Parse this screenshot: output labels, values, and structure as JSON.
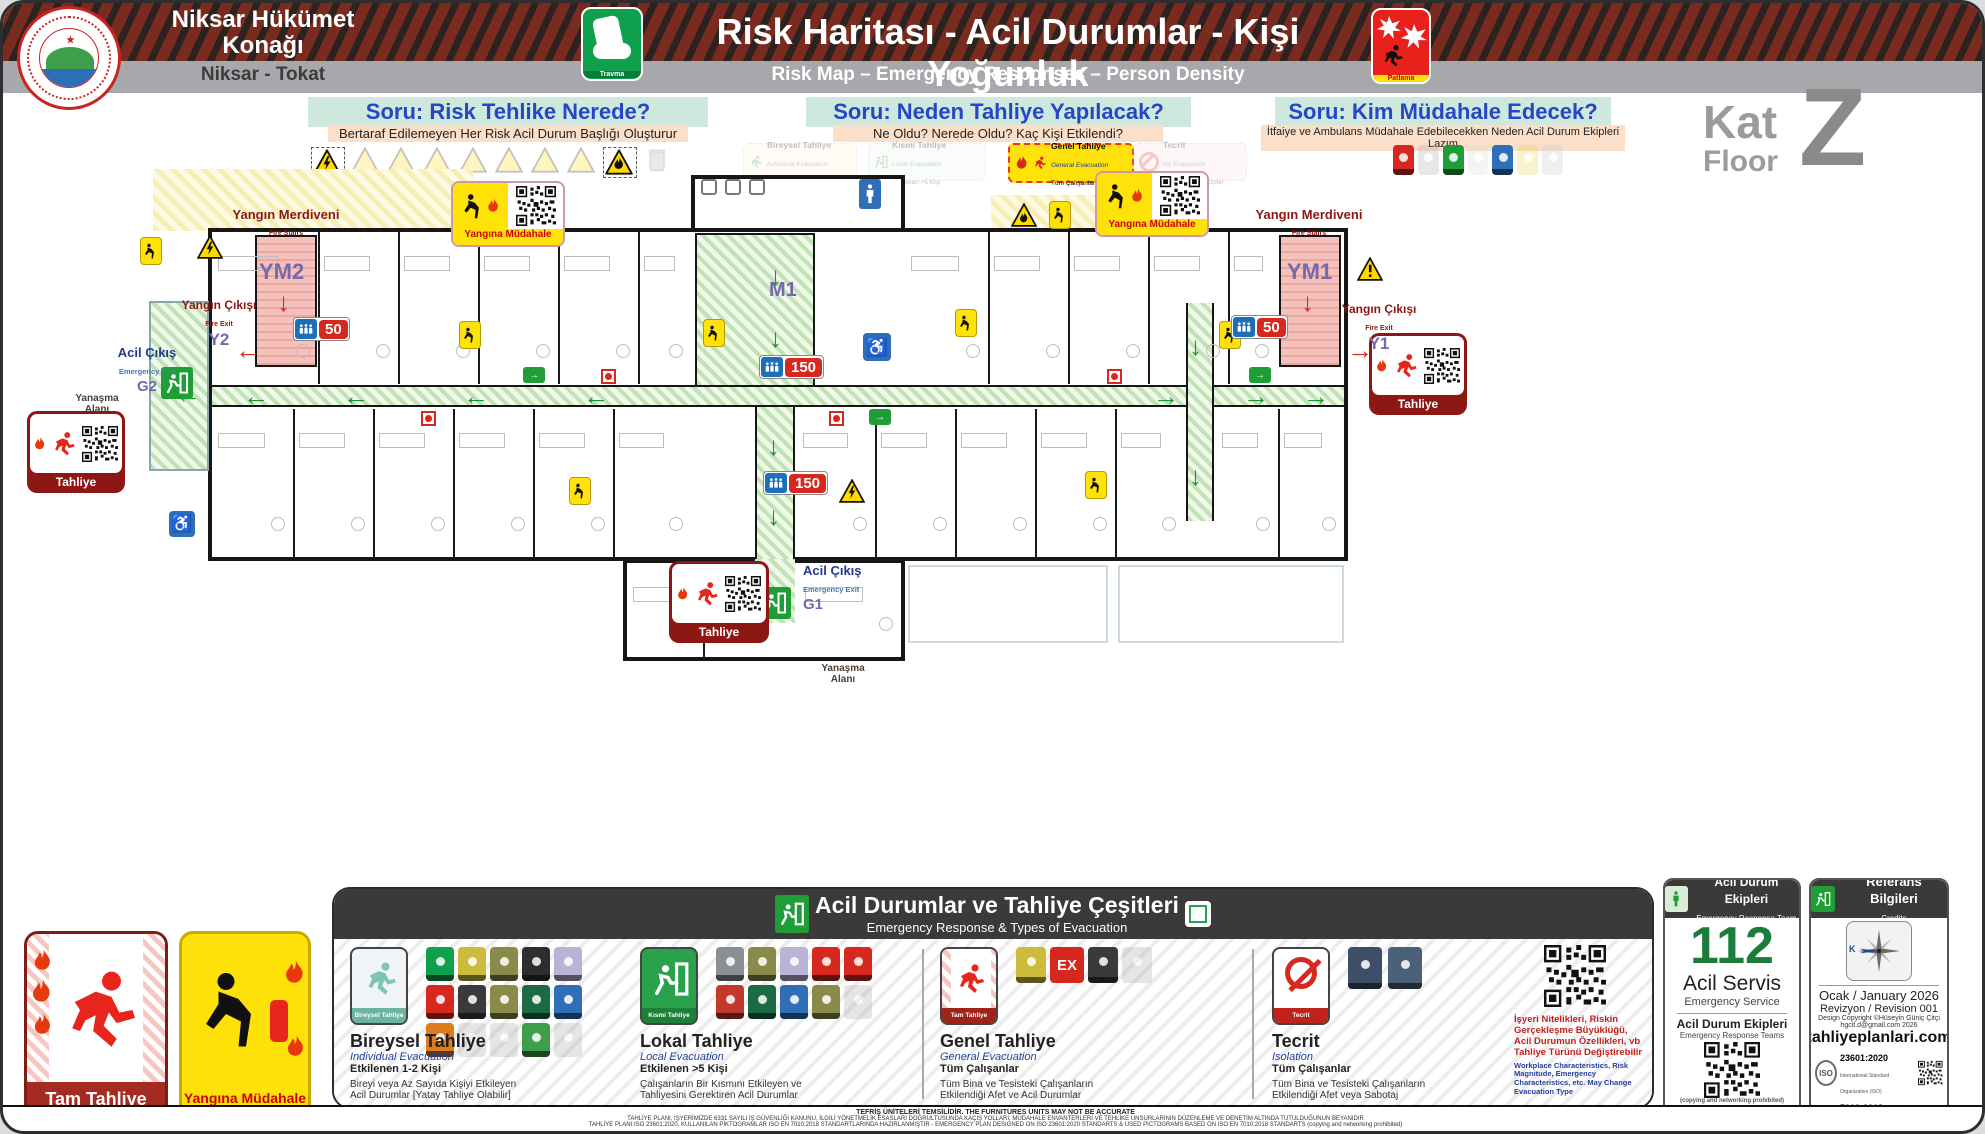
{
  "header": {
    "building_name": "Niksar Hükümet Konağı",
    "location": "Niksar - Tokat",
    "title": "Risk Haritası - Acil Durumlar - Kişi Yoğunluk",
    "subtitle": "Risk Map – Emergency Responses – Person Density",
    "travma_label": "Travma",
    "patlama_label": "Patlama"
  },
  "floor_badge": {
    "kat": "Kat",
    "floor": "Floor",
    "letter": "Z"
  },
  "questions": [
    {
      "title": "Soru: Risk Tehlike Nerede?",
      "subtitle": "Bertaraf Edilemeyen Her Risk Acil Durum Başlığı Oluşturur"
    },
    {
      "title": "Soru: Neden Tahliye Yapılacak?",
      "subtitle": "Ne Oldu? Nerede Oldu? Kaç Kişi Etkilendi?"
    },
    {
      "title": "Soru: Kim Müdahale Edecek?",
      "subtitle": "İtfaiye ve Ambulans Müdahale Edebilecekken Neden Acil Durum Ekipleri Lazım"
    }
  ],
  "evacuation_badges": [
    {
      "title": "Bireysel Tahliye",
      "en": "Individual Evacuation",
      "info": "Etkilenen 1-2 Kişi"
    },
    {
      "title": "Kısmi Tahliye",
      "en": "Local Evacuation",
      "info": "Etkilenen >5 Kişi"
    },
    {
      "title": "Genel Tahliye",
      "en": "General Evacuation",
      "info": "Tüm Çalışanlar"
    },
    {
      "title": "Tecrit",
      "en": "No Evacuation",
      "info": "Etkilenen Tüm Kişiler"
    }
  ],
  "plan": {
    "fire_stairs_tr": "Yangın Merdiveni",
    "fire_stairs_en": "Fire Stairs",
    "ym2": "YM2",
    "ym1": "YM1",
    "m1": "M1",
    "fire_exit_tr": "Yangın Çıkışı",
    "fire_exit_en": "Fire Exit",
    "y2": "Y2",
    "y1": "Y1",
    "emergency_exit_tr": "Acil Çıkış",
    "emergency_exit_en": "Emergency Exit",
    "g2": "G2",
    "g1": "G1",
    "approach_area_1": "Yanaşma",
    "approach_area_2": "Alanı",
    "count_main": "150",
    "count_wing": "50",
    "tahliye_label": "Tahliye",
    "fire_response_label": "Yangına Müdahale"
  },
  "legend": {
    "title_tr": "Acil Durumlar ve Tahliye Çeşitleri",
    "title_en": "Emergency Response & Types of Evacuation",
    "sections": [
      {
        "badge": "Bireysel Tahliye",
        "title": "Bireysel Tahliye",
        "en": "Individual Evacuation",
        "affected": "Etkilenen 1-2 Kişi",
        "desc": "Bireyi veya Az Sayıda Kişiyi Etkileyen Acil Durumlar [Yatay Tahliye Olabilir]"
      },
      {
        "badge": "Kısmi Tahliye",
        "title": "Lokal Tahliye",
        "en": "Local Evacuation",
        "affected": "Etkilenen >5 Kişi",
        "desc": "Çalışanların Bir Kısmını Etkileyen ve Tahliyesini Gerektiren Acil Durumlar"
      },
      {
        "badge": "Tam Tahliye",
        "title": "Genel Tahliye",
        "en": "General Evacuation",
        "affected": "Tüm Çalışanlar",
        "desc": "Tüm Bina ve Tesisteki Çalışanların Etkilendiği Afet ve Acil Durumlar"
      },
      {
        "badge": "Tecrit",
        "title": "Tecrit",
        "en": "Isolation",
        "affected": "Tüm Çalışanlar",
        "desc": "Tüm Bina ve Tesisteki Çalışanların Etkilendiği Afet veya Sabotaj"
      }
    ],
    "ex_label": "EX",
    "note_tr": "İşyeri Nitelikleri, Riskin Gerçekleşme Büyüklüğü, Acil Durumun Özellikleri, vb Tahliye Türünü Değiştirebilir",
    "note_en": "Workplace Characteristics, Risk Magnitude, Emergency Characteristics, etc. May Change Evacuation Type"
  },
  "big_badges": {
    "full_evacuation": "Tam Tahliye",
    "fire_response": "Yangına Müdahale"
  },
  "emergency_panel": {
    "header_tr": "Acil Durum Ekipleri",
    "header_en": "Emergency Response Team",
    "number": "112",
    "service_tr": "Acil Servis",
    "service_en": "Emergency Service",
    "teams_tr": "Acil Durum Ekipleri",
    "teams_en": "Emergency Response Teams",
    "copy_note": "(copying and networking prohibited)"
  },
  "credits_panel": {
    "header_tr": "Referans Bilgileri",
    "header_en": "Credits",
    "north": "K",
    "date": "Ocak / January 2026",
    "revision": "Revizyon / Revision  001",
    "copyright1": "Design Copyright ©Hüseyin Güniç Çitçi",
    "copyright2": "hgcit.d@gmail.com 2026",
    "website": "tahliyeplanlari.com",
    "iso_label": "ISO",
    "iso1": "23601:2020",
    "iso1_sub": "International Standard Organization (ISO)",
    "iso2": "7010:2018",
    "iso2_sub": "International Standard Organization (ISO)",
    "copy_note": "(copying and networking prohibited)"
  },
  "footer": {
    "line1": "TEFRİŞ ÜNİTELERİ TEMSİLİDİR. THE FURNITURES UNITS MAY NOT BE ACCURATE",
    "line2": "TAHLİYE PLANI, İŞYERİMİZDE 6331 SAYILI İŞ GÜVENLİĞİ KANUNU, İLGİLİ YÖNETMELİK ESASLARI DOĞRULTUSUNDA KAÇIŞ YOLLARI, MÜDAHALE ENVANTERLERİ VE TEHLİKE UNSURLARININ DÜZENLEME VE DENETİM ALTINDA TUTULDUĞUNUN BEYANIDIR",
    "line3": "TAHLİYE PLANI ISO 23601:2020, KULLANILAN PİKTOGRAMLAR ISO EN 7010:2018 STANDARTLARINDA HAZIRLANMIŞTIR - EMERGENCY PLAN DESIGNED ON ISO 23601:2020 STANDARTS & USED PICTOGRAMS BASED ON ISO EN 7010:2018 STANDARTS (copying and networking prohibited)"
  },
  "colors": {
    "accent_green": "#1f9e38",
    "accent_red": "#c1272d",
    "purple": "#7668ac",
    "dark_red": "#8c1712"
  }
}
